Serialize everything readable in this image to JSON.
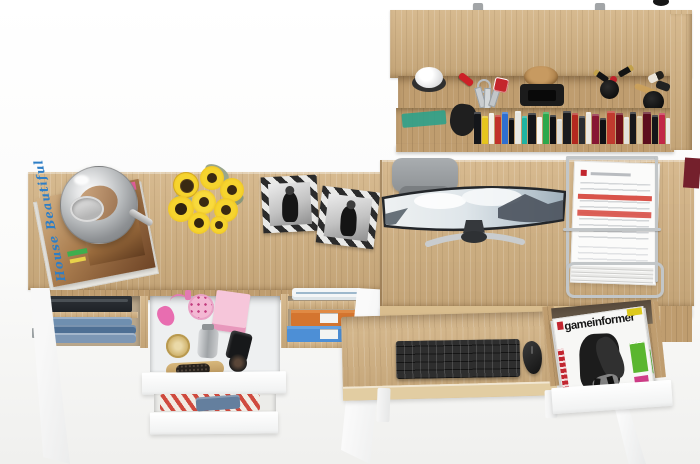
{
  "texts": {
    "house_magazine_title": "House Beautiful",
    "game_magazine_title": "gameinformer"
  },
  "palette": {
    "wood_oak": "#d2b283",
    "wood_oak_dark": "#bf9d6f",
    "front_white": "#ffffff",
    "background": "#f4f4f2",
    "chrome_wire": "#c2c6c8",
    "magazine_red": "#c22630",
    "magazine_green": "#5ab62f",
    "magazine_magenta": "#cf3d88",
    "perfume_pink": "#e86db0",
    "sunflower_yellow": "#edc523",
    "sunflower_center": "#3a2a12",
    "orange_box": "#d4752f",
    "blue_box": "#4d8fd6",
    "denim_blue": "#5b7da3",
    "stripe_red": "#cf4a3e",
    "monitor_bezel": "#23262a",
    "chair_grey": "#9aa0a4"
  },
  "shelf": {
    "books": [
      {
        "c": "#14161a",
        "w": 7,
        "h": 34
      },
      {
        "c": "#e5c51e",
        "w": 6,
        "h": 30
      },
      {
        "c": "#f2f0e8",
        "w": 5,
        "h": 33
      },
      {
        "c": "#c23129",
        "w": 6,
        "h": 31
      },
      {
        "c": "#2f6fd0",
        "w": 7,
        "h": 34
      },
      {
        "c": "#101114",
        "w": 5,
        "h": 28
      },
      {
        "c": "#e8e8e4",
        "w": 6,
        "h": 35
      },
      {
        "c": "#1fb3a2",
        "w": 5,
        "h": 30
      },
      {
        "c": "#15161a",
        "w": 8,
        "h": 33
      },
      {
        "c": "#f5f5f2",
        "w": 5,
        "h": 29
      },
      {
        "c": "#2da84c",
        "w": 6,
        "h": 34
      },
      {
        "c": "#0f1013",
        "w": 6,
        "h": 31
      },
      {
        "c": "#dcdcd8",
        "w": 5,
        "h": 27
      },
      {
        "c": "#191a1e",
        "w": 9,
        "h": 35
      },
      {
        "c": "#b3281f",
        "w": 6,
        "h": 33
      },
      {
        "c": "#2a2c30",
        "w": 6,
        "h": 30
      },
      {
        "c": "#ece9e2",
        "w": 5,
        "h": 34
      },
      {
        "c": "#871733",
        "w": 7,
        "h": 32
      },
      {
        "c": "#101114",
        "w": 6,
        "h": 28
      },
      {
        "c": "#c13a2e",
        "w": 8,
        "h": 35
      },
      {
        "c": "#6e0f1a",
        "w": 7,
        "h": 33
      },
      {
        "c": "#e4e2dc",
        "w": 5,
        "h": 29
      },
      {
        "c": "#17181c",
        "w": 7,
        "h": 34
      },
      {
        "c": "#d9c8a4",
        "w": 5,
        "h": 30
      },
      {
        "c": "#5c0e1e",
        "w": 8,
        "h": 34
      },
      {
        "c": "#141519",
        "w": 6,
        "h": 31
      },
      {
        "c": "#c22848",
        "w": 6,
        "h": 33
      },
      {
        "c": "#ececea",
        "w": 4,
        "h": 28
      }
    ]
  }
}
